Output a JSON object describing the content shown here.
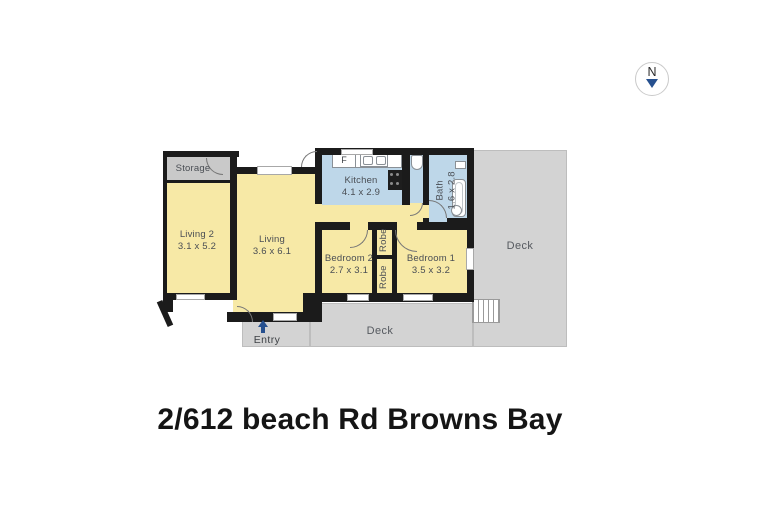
{
  "title": "2/612 beach Rd Browns Bay",
  "compass": {
    "direction": "N"
  },
  "floorplan": {
    "rooms": {
      "storage": {
        "label": "Storage"
      },
      "living2": {
        "label": "Living 2",
        "dims": "3.1 x 5.2"
      },
      "living": {
        "label": "Living",
        "dims": "3.6 x 6.1"
      },
      "kitchen": {
        "label": "Kitchen",
        "dims": "4.1 x 2.9"
      },
      "bath": {
        "label": "Bath",
        "dims": "1.6 x 2.8"
      },
      "bedroom2": {
        "label": "Bedroom 2",
        "dims": "2.7 x 3.1"
      },
      "bedroom1": {
        "label": "Bedroom 1",
        "dims": "3.5 x 3.2"
      },
      "robe_upper": {
        "label": "Robe"
      },
      "robe_lower": {
        "label": "Robe"
      },
      "deck_side": {
        "label": "Deck"
      },
      "deck_front": {
        "label": "Deck"
      }
    },
    "markers": {
      "entry": "Entry",
      "fridge": "F"
    },
    "colors": {
      "room_fill": "#F7E9A6",
      "wet_area_fill": "#BED7E9",
      "outdoor_fill": "#D3D3D3",
      "wall": "#1B1B1B",
      "accent_navy": "#26508F"
    }
  }
}
